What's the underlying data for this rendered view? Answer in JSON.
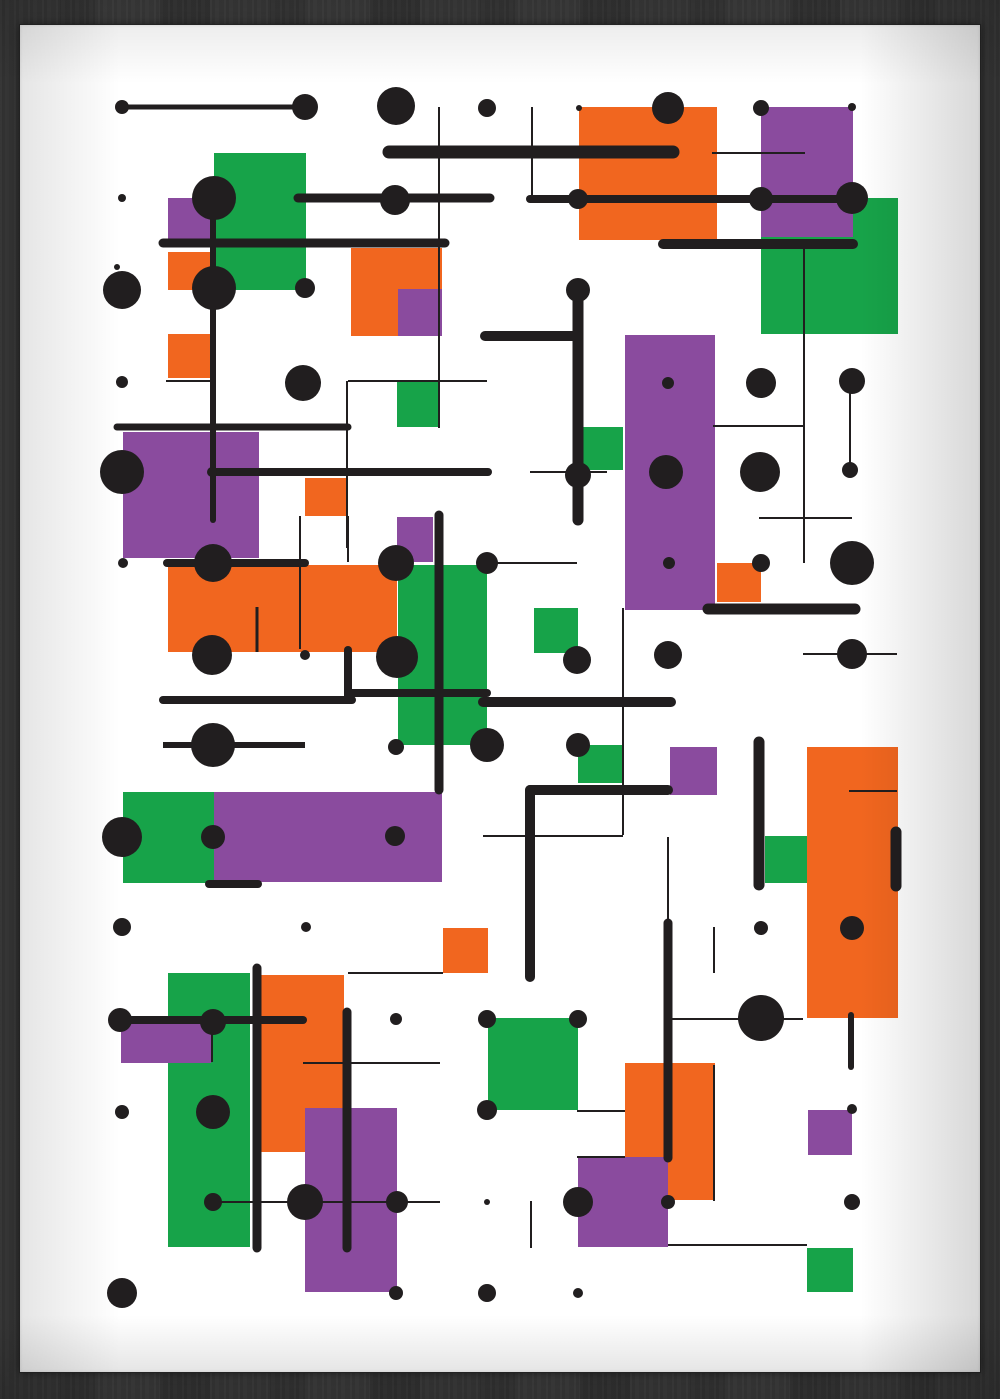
{
  "artwork": {
    "title_semantic": "abstract-geometric-art-print",
    "palette": {
      "paper": "#ffffff",
      "black": "#211e1f",
      "orange": "#f1661f",
      "green": "#17a349",
      "purple": "#8a4b9e",
      "wall_wood": "#383838"
    },
    "frame": {
      "paper_x": 20,
      "paper_y": 25,
      "paper_w": 960,
      "paper_h": 1347
    },
    "canvas": {
      "w": 1000,
      "h": 1399
    },
    "rects": [
      [
        214,
        153,
        92,
        137,
        "green"
      ],
      [
        168,
        198,
        46,
        46,
        "purple"
      ],
      [
        168,
        252,
        44,
        38,
        "orange"
      ],
      [
        168,
        334,
        44,
        44,
        "orange"
      ],
      [
        351,
        248,
        91,
        88,
        "orange"
      ],
      [
        398,
        289,
        44,
        47,
        "purple"
      ],
      [
        579,
        107,
        138,
        133,
        "orange"
      ],
      [
        761,
        198,
        137,
        136,
        "green"
      ],
      [
        761,
        107,
        92,
        130,
        "purple"
      ],
      [
        397,
        382,
        43,
        45,
        "green"
      ],
      [
        123,
        432,
        136,
        126,
        "purple"
      ],
      [
        305,
        478,
        43,
        38,
        "orange"
      ],
      [
        397,
        517,
        36,
        45,
        "purple"
      ],
      [
        625,
        335,
        90,
        275,
        "purple"
      ],
      [
        582,
        427,
        41,
        43,
        "green"
      ],
      [
        168,
        565,
        229,
        87,
        "orange"
      ],
      [
        398,
        565,
        89,
        180,
        "green"
      ],
      [
        534,
        608,
        44,
        45,
        "green"
      ],
      [
        717,
        563,
        44,
        39,
        "orange"
      ],
      [
        123,
        792,
        91,
        91,
        "green"
      ],
      [
        214,
        792,
        228,
        90,
        "purple"
      ],
      [
        443,
        928,
        45,
        45,
        "orange"
      ],
      [
        670,
        747,
        47,
        48,
        "purple"
      ],
      [
        765,
        836,
        43,
        47,
        "green"
      ],
      [
        807,
        747,
        91,
        271,
        "orange"
      ],
      [
        578,
        745,
        45,
        38,
        "green"
      ],
      [
        168,
        973,
        82,
        274,
        "green"
      ],
      [
        258,
        975,
        86,
        177,
        "orange"
      ],
      [
        305,
        1108,
        92,
        184,
        "purple"
      ],
      [
        121,
        1024,
        90,
        39,
        "purple"
      ],
      [
        488,
        1018,
        90,
        92,
        "green"
      ],
      [
        625,
        1063,
        90,
        137,
        "orange"
      ],
      [
        578,
        1157,
        90,
        90,
        "purple"
      ],
      [
        808,
        1110,
        44,
        45,
        "purple"
      ],
      [
        807,
        1248,
        46,
        44,
        "green"
      ]
    ],
    "lines": [
      [
        122,
        107,
        305,
        107,
        5,
        "round"
      ],
      [
        389,
        152,
        673,
        152,
        13,
        "round"
      ],
      [
        298,
        198,
        490,
        198,
        9,
        "round"
      ],
      [
        530,
        199,
        852,
        199,
        8,
        "round"
      ],
      [
        163,
        243,
        445,
        243,
        9,
        "round"
      ],
      [
        663,
        244,
        853,
        244,
        10,
        "round"
      ],
      [
        213,
        198,
        213,
        520,
        6,
        "round"
      ],
      [
        117,
        427,
        348,
        427,
        7,
        "round"
      ],
      [
        212,
        472,
        488,
        472,
        8,
        "round"
      ],
      [
        167,
        563,
        305,
        563,
        8,
        "round"
      ],
      [
        578,
        290,
        578,
        520,
        11,
        "round"
      ],
      [
        485,
        336,
        578,
        336,
        10,
        "round"
      ],
      [
        439,
        515,
        439,
        790,
        9,
        "round"
      ],
      [
        163,
        700,
        352,
        700,
        8,
        "round"
      ],
      [
        348,
        650,
        348,
        700,
        8,
        "round"
      ],
      [
        348,
        693,
        487,
        693,
        8,
        "round"
      ],
      [
        483,
        702,
        671,
        702,
        10,
        "round"
      ],
      [
        163,
        745,
        305,
        745,
        6,
        "butt"
      ],
      [
        209,
        884,
        258,
        884,
        8,
        "round"
      ],
      [
        530,
        790,
        668,
        790,
        10,
        "round"
      ],
      [
        530,
        790,
        530,
        977,
        10,
        "round"
      ],
      [
        708,
        609,
        855,
        609,
        11,
        "round"
      ],
      [
        759,
        742,
        759,
        885,
        11,
        "round"
      ],
      [
        896,
        832,
        896,
        886,
        11,
        "round"
      ],
      [
        668,
        923,
        668,
        1158,
        9,
        "round"
      ],
      [
        120,
        1020,
        303,
        1020,
        8,
        "round"
      ],
      [
        257,
        968,
        257,
        1248,
        9,
        "round"
      ],
      [
        347,
        1012,
        347,
        1248,
        9,
        "round"
      ],
      [
        851,
        1015,
        851,
        1067,
        6,
        "round"
      ],
      [
        439,
        107,
        439,
        428,
        2,
        "butt"
      ],
      [
        532,
        107,
        532,
        199,
        2,
        "butt"
      ],
      [
        712,
        153,
        805,
        153,
        2,
        "butt"
      ],
      [
        166,
        381,
        212,
        381,
        2,
        "butt"
      ],
      [
        348,
        381,
        487,
        381,
        2,
        "butt"
      ],
      [
        347,
        381,
        347,
        548,
        2,
        "butt"
      ],
      [
        804,
        248,
        804,
        563,
        2,
        "butt"
      ],
      [
        713,
        426,
        803,
        426,
        2,
        "butt"
      ],
      [
        530,
        472,
        607,
        472,
        2,
        "butt"
      ],
      [
        759,
        518,
        852,
        518,
        2,
        "butt"
      ],
      [
        487,
        563,
        577,
        563,
        2,
        "butt"
      ],
      [
        300,
        516,
        300,
        649,
        2,
        "butt"
      ],
      [
        348,
        516,
        348,
        562,
        2,
        "butt"
      ],
      [
        257,
        607,
        257,
        652,
        3,
        "butt"
      ],
      [
        850,
        383,
        850,
        470,
        2,
        "butt"
      ],
      [
        483,
        836,
        623,
        836,
        2,
        "butt"
      ],
      [
        623,
        608,
        623,
        835,
        2,
        "butt"
      ],
      [
        803,
        654,
        897,
        654,
        2,
        "butt"
      ],
      [
        668,
        837,
        668,
        923,
        2,
        "butt"
      ],
      [
        714,
        927,
        714,
        973,
        2,
        "butt"
      ],
      [
        849,
        791,
        897,
        791,
        2,
        "butt"
      ],
      [
        668,
        1019,
        803,
        1019,
        2,
        "butt"
      ],
      [
        348,
        973,
        443,
        973,
        2,
        "butt"
      ],
      [
        212,
        1022,
        212,
        1062,
        2,
        "butt"
      ],
      [
        303,
        1063,
        440,
        1063,
        2,
        "butt"
      ],
      [
        213,
        1202,
        440,
        1202,
        2,
        "butt"
      ],
      [
        577,
        1111,
        625,
        1111,
        2,
        "butt"
      ],
      [
        577,
        1157,
        625,
        1157,
        2,
        "butt"
      ],
      [
        714,
        1065,
        714,
        1201,
        2,
        "butt"
      ],
      [
        531,
        1201,
        531,
        1248,
        2,
        "butt"
      ],
      [
        668,
        1245,
        807,
        1245,
        2,
        "butt"
      ]
    ],
    "dots": [
      [
        122,
        107,
        7
      ],
      [
        305,
        107,
        13
      ],
      [
        396,
        106,
        19
      ],
      [
        487,
        108,
        9
      ],
      [
        579,
        108,
        3
      ],
      [
        668,
        108,
        16
      ],
      [
        761,
        108,
        8
      ],
      [
        852,
        107,
        4
      ],
      [
        122,
        198,
        4
      ],
      [
        214,
        198,
        22
      ],
      [
        214,
        288,
        22
      ],
      [
        395,
        200,
        15
      ],
      [
        578,
        199,
        10
      ],
      [
        761,
        199,
        12
      ],
      [
        852,
        198,
        16
      ],
      [
        122,
        290,
        19
      ],
      [
        117,
        267,
        3
      ],
      [
        305,
        288,
        10
      ],
      [
        578,
        290,
        12
      ],
      [
        761,
        383,
        15
      ],
      [
        852,
        381,
        13
      ],
      [
        668,
        383,
        6
      ],
      [
        122,
        382,
        6
      ],
      [
        303,
        383,
        18
      ],
      [
        122,
        472,
        22
      ],
      [
        212,
        472,
        5
      ],
      [
        578,
        475,
        13
      ],
      [
        666,
        472,
        17
      ],
      [
        760,
        472,
        20
      ],
      [
        850,
        470,
        8
      ],
      [
        396,
        563,
        18
      ],
      [
        487,
        563,
        11
      ],
      [
        669,
        563,
        6
      ],
      [
        761,
        563,
        9
      ],
      [
        852,
        563,
        22
      ],
      [
        213,
        563,
        19
      ],
      [
        123,
        563,
        5
      ],
      [
        212,
        655,
        20
      ],
      [
        397,
        657,
        21
      ],
      [
        305,
        655,
        5
      ],
      [
        577,
        660,
        14
      ],
      [
        668,
        655,
        14
      ],
      [
        852,
        654,
        15
      ],
      [
        487,
        745,
        17
      ],
      [
        396,
        747,
        8
      ],
      [
        578,
        745,
        12
      ],
      [
        213,
        745,
        22
      ],
      [
        395,
        836,
        10
      ],
      [
        122,
        837,
        20
      ],
      [
        213,
        837,
        12
      ],
      [
        122,
        927,
        9
      ],
      [
        306,
        927,
        5
      ],
      [
        761,
        928,
        7
      ],
      [
        852,
        928,
        12
      ],
      [
        761,
        1018,
        23
      ],
      [
        120,
        1020,
        12
      ],
      [
        213,
        1022,
        13
      ],
      [
        487,
        1019,
        9
      ],
      [
        578,
        1019,
        9
      ],
      [
        396,
        1019,
        6
      ],
      [
        122,
        1112,
        7
      ],
      [
        213,
        1112,
        17
      ],
      [
        852,
        1109,
        5
      ],
      [
        487,
        1110,
        10
      ],
      [
        213,
        1202,
        9
      ],
      [
        305,
        1202,
        18
      ],
      [
        397,
        1202,
        11
      ],
      [
        578,
        1202,
        15
      ],
      [
        668,
        1202,
        7
      ],
      [
        852,
        1202,
        8
      ],
      [
        487,
        1202,
        3
      ],
      [
        122,
        1293,
        15
      ],
      [
        396,
        1293,
        7
      ],
      [
        487,
        1293,
        9
      ],
      [
        578,
        1293,
        5
      ]
    ]
  }
}
